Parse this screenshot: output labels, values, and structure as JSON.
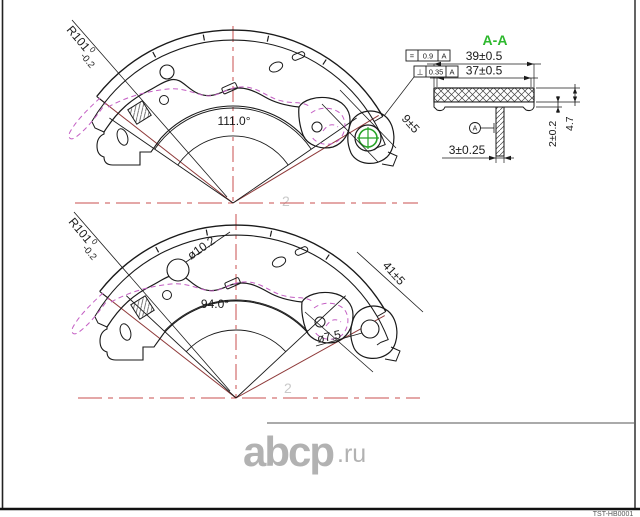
{
  "frame": {
    "part_number": "TST-HB0001"
  },
  "watermark": {
    "logo": "abcp",
    "tld": ".ru",
    "ghost_digit": "2"
  },
  "top_view": {
    "radius_prefix": "R101",
    "radius_tol_upper": "0",
    "radius_tol_lower": "-0.2",
    "angle_label": "111.0°",
    "end_width_label": "9±5"
  },
  "bottom_view": {
    "radius_prefix": "R101",
    "radius_tol_upper": "0",
    "radius_tol_lower": "-0.2",
    "angle_label": "94.0°",
    "end_width_label": "41±5",
    "hole_large_label": "ø10.2",
    "hole_small_label": "ø7.5"
  },
  "section": {
    "title": "A-A",
    "width_outer": "39±0.5",
    "width_inner": "37±0.5",
    "tol_parallel": {
      "symbol": "=",
      "value": "0.9",
      "datum": "A"
    },
    "tol_perp": {
      "symbol": "⊥",
      "value": "0.35",
      "datum": "A"
    },
    "stem_width": "3±0.25",
    "plate_thickness": "2±0.2",
    "lining_depth": "4.7",
    "datum_label": "A"
  }
}
